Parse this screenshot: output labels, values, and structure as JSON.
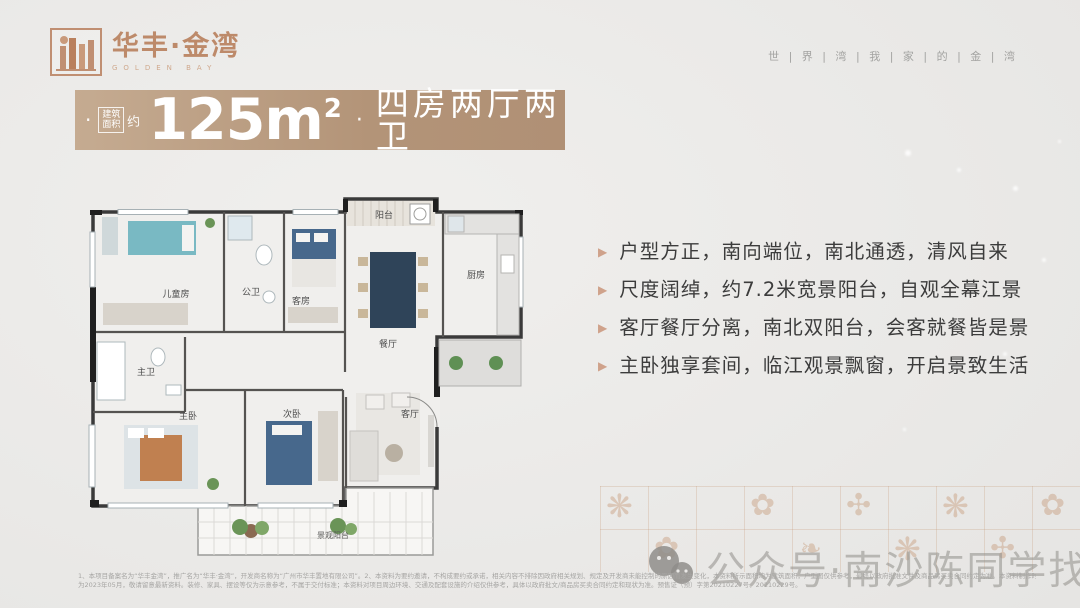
{
  "colors": {
    "accent_copper": "#bf8f70",
    "banner_from": "#c5ab91",
    "banner_to": "#b09075",
    "page_bg": "#e9e8e6",
    "bullet_marker": "#cfa28b",
    "watermark_gray": "#969490"
  },
  "logo": {
    "cn": "华丰·金湾",
    "en": "GOLDEN BAY"
  },
  "header": {
    "tagline": "世 | 界 | 湾 | 我 | 家 | 的 | 金 | 湾"
  },
  "banner": {
    "dot1": "·",
    "tag_line1": "建筑",
    "tag_line2": "面积",
    "approx": "约",
    "value": "125m",
    "sup": "2",
    "dot2": "·",
    "layout": "四房两厅两卫"
  },
  "floorplan": {
    "rooms": [
      {
        "id": "balcony-north",
        "label": "阳台"
      },
      {
        "id": "kitchen",
        "label": "厨房"
      },
      {
        "id": "bath-public",
        "label": "公卫"
      },
      {
        "id": "kids-room",
        "label": "儿童房"
      },
      {
        "id": "guest-room",
        "label": "客房"
      },
      {
        "id": "dining-room",
        "label": "餐厅"
      },
      {
        "id": "bath-master",
        "label": "主卫"
      },
      {
        "id": "master-bedroom",
        "label": "主卧"
      },
      {
        "id": "second-bedroom",
        "label": "次卧"
      },
      {
        "id": "living-room",
        "label": "客厅"
      },
      {
        "id": "view-balcony",
        "label": "景观阳台"
      }
    ]
  },
  "highlights": {
    "items": [
      "户型方正，南向端位，南北通透，清风自来",
      "尺度阔绰，约7.2米宽景阳台，自观全幕江景",
      "客厅餐厅分离，南北双阳台，会客就餐皆是景",
      "主卧独享套间，临江观景飘窗，开启景致生活"
    ]
  },
  "watermark": {
    "icon": "wechat-icon",
    "text": "公众号·南沙陈同学找房"
  },
  "disclaimer": {
    "line1": "1、本项目备案名为“华丰金湾”，推广名为“华丰·金湾”，开发商名称为“广州市华丰置地有限公司”。2、本资料为要约邀请，不构成要约或承诺，相关内容不排除因政府相关规划、规定及开发商未能控制的原因而发生变化，本资料所示面积均为建筑面积，户型图仅供参考，最终以政府批准文件及商品房买卖合同约定为准。本资料制作时间",
    "line2": "为2023年05月，敬请留意最新资料。装修、家具、摆设等仅为示意参考，不属于交付标准；本资料对项目周边环境、交通及配套设施的介绍仅供参考，具体以政府批文/商品房买卖合同约定和现状为准。预售证（预）字第20210227号、20210229号。"
  }
}
